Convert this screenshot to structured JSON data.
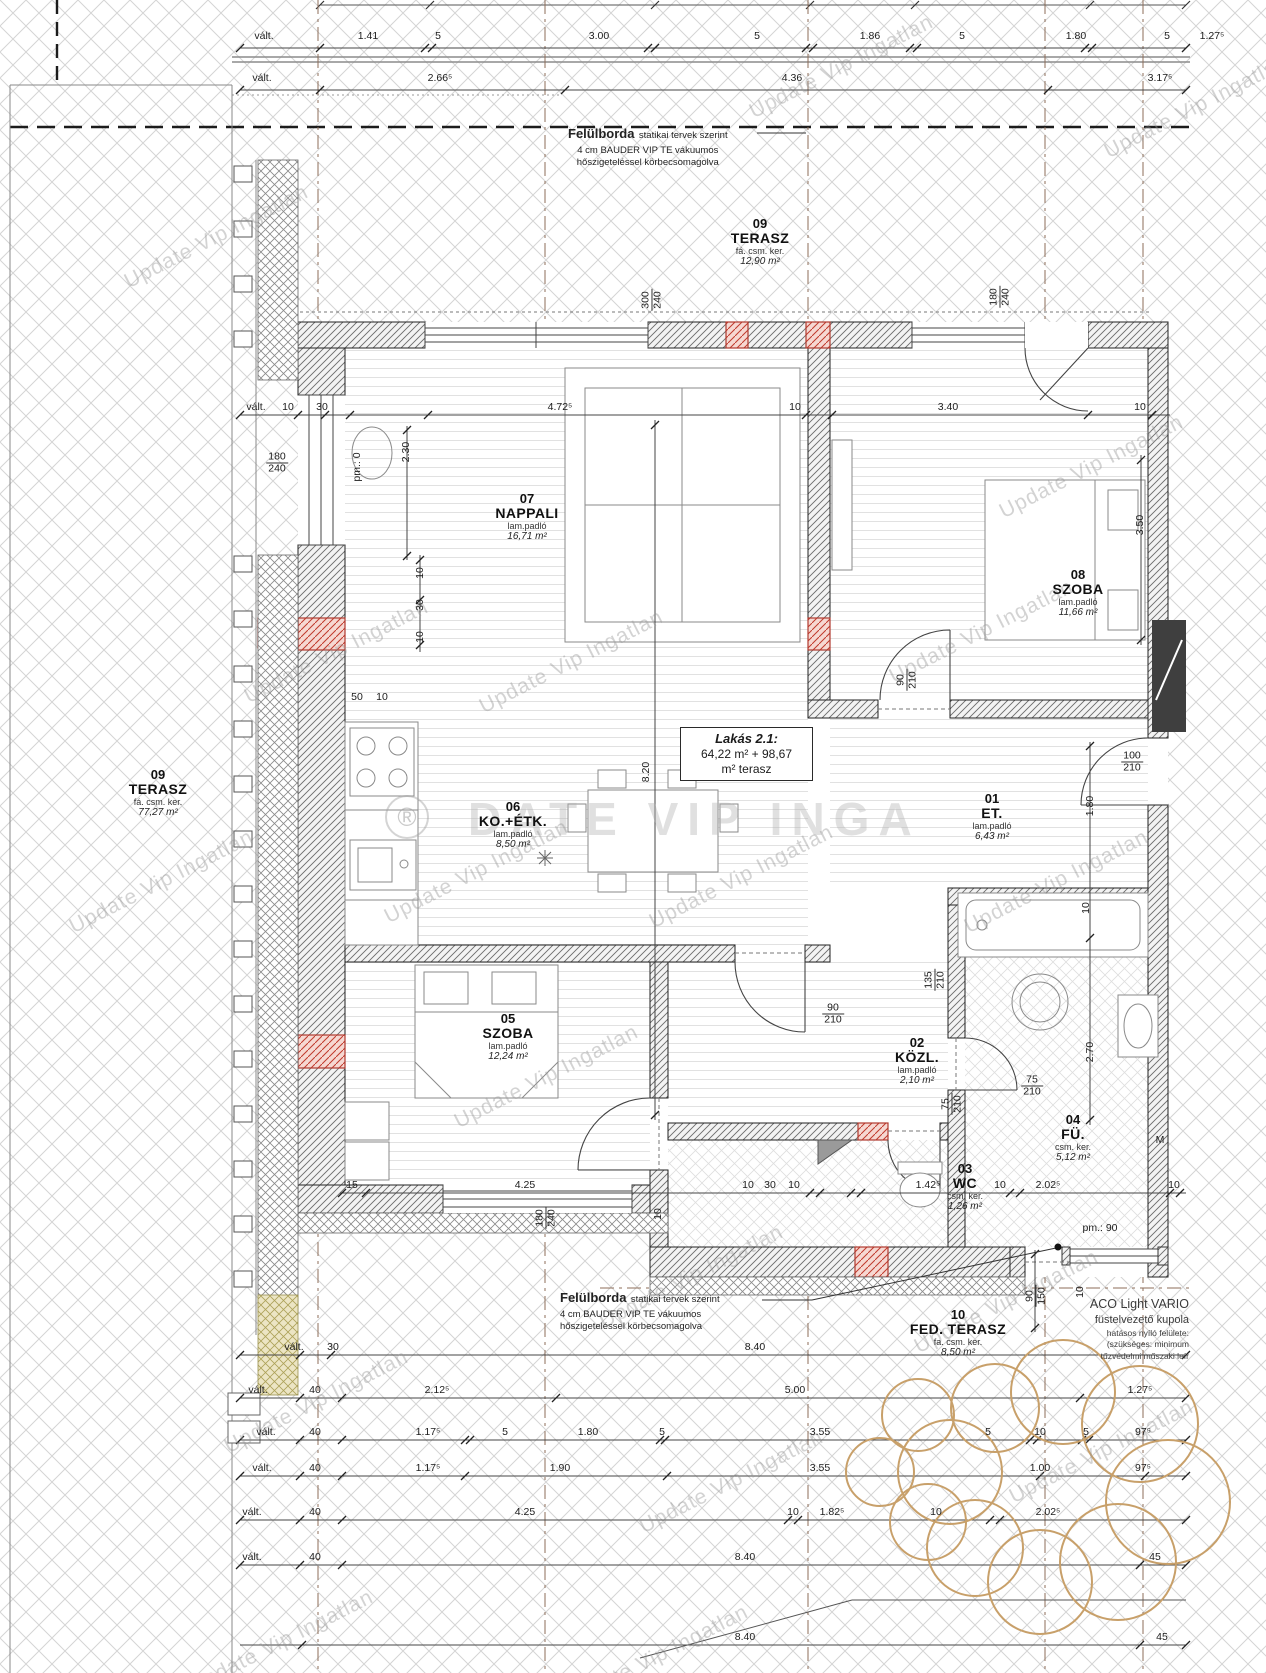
{
  "sheet": {
    "watermark": "Update Vip Ingatlan",
    "watermark_big": "DATE VIP INGA",
    "reg": "®",
    "lakas": {
      "title": "Lakás 2.1:",
      "l1": "64,22 m² + 98,67",
      "l2": "m² terasz"
    },
    "note_top": {
      "strong": "Felülborda",
      "rest": "statikai tervek szerint",
      "l2": "4 cm BAUDER VIP TE vákuumos",
      "l3": "hőszigeteléssel körbecsomagolva"
    },
    "note_bottom": {
      "strong": "Felülborda",
      "rest": "statikai tervek szerint",
      "l2": "4 cm BAUDER VIP TE vákuumos",
      "l3": "hőszigeteléssel körbecsomagolva"
    },
    "aco": {
      "l1": "ACO Light VARIO",
      "l2": "füstelvezető kupola",
      "l3": "hatásos nyíló felülete:",
      "l4": "(szükséges: minimum",
      "l5": "tűzvédelmi műszaki leír"
    },
    "rooms": {
      "terasz_top": {
        "num": "09",
        "name": "TERASZ",
        "floor": "fá. csm. ker.",
        "area": "12,90 m²"
      },
      "terasz_left": {
        "num": "09",
        "name": "TERASZ",
        "floor": "fá. csm. ker.",
        "area": "77,27 m²"
      },
      "nappali": {
        "num": "07",
        "name": "NAPPALI",
        "floor": "lam.padló",
        "area": "16,71 m²"
      },
      "szoba8": {
        "num": "08",
        "name": "SZOBA",
        "floor": "lam.padló",
        "area": "11,66 m²"
      },
      "koetk": {
        "num": "06",
        "name": "KO.+ÉTK.",
        "floor": "lam.padló",
        "area": "8,50 m²"
      },
      "et": {
        "num": "01",
        "name": "ET.",
        "floor": "lam.padló",
        "area": "6,43 m²"
      },
      "szoba5": {
        "num": "05",
        "name": "SZOBA",
        "floor": "lam.padló",
        "area": "12,24 m²"
      },
      "kozl": {
        "num": "02",
        "name": "KÖZL.",
        "floor": "lam.padló",
        "area": "2,10 m²"
      },
      "fu": {
        "num": "04",
        "name": "FÜ.",
        "floor": "csm. ker.",
        "area": "5,12 m²"
      },
      "wc": {
        "num": "03",
        "name": "WC",
        "floor": "csm. ker.",
        "area": "1,26 m²"
      },
      "fedterasz": {
        "num": "10",
        "name": "FED. TERASZ",
        "floor": "fa. csm. ker.",
        "area": "8,50 m²"
      }
    },
    "dims": {
      "top1": [
        "vált.",
        "1.41",
        "5",
        "3.00",
        "5",
        "1.86",
        "5",
        "1.80",
        "5",
        "1.27⁵"
      ],
      "top2": [
        "vált.",
        "2.66⁵",
        "4.36",
        "3.17⁵"
      ],
      "mid": [
        "vált.",
        "10",
        "30",
        "4.72⁵",
        "10",
        "3.40",
        "10"
      ],
      "b1": [
        "vált.",
        "30",
        "8.40"
      ],
      "b2": [
        "vált.",
        "40",
        "2.12⁵",
        "5.00",
        "1.27⁵"
      ],
      "b3": [
        "vált.",
        "40",
        "1.17⁵",
        "5",
        "1.80",
        "5",
        "3.55",
        "5",
        "10",
        "5",
        "97⁵"
      ],
      "b4": [
        "vált.",
        "40",
        "1.17⁵",
        "1.90",
        "3.55",
        "1.00",
        "97⁵"
      ],
      "b5": [
        "vált.",
        "40",
        "4.25",
        "10",
        "1.82⁵",
        "10",
        "2.02⁵"
      ],
      "b6": [
        "vált.",
        "40",
        "8.40",
        "45"
      ],
      "b7": [
        "8.40",
        "45"
      ],
      "wcrow": [
        "15",
        "4.25",
        "10",
        "30",
        "10",
        "1.42⁵",
        "10",
        "2.02⁵",
        "10"
      ],
      "labels": {
        "ten": "10",
        "thirty": "30",
        "d50": "50",
        "m": "M",
        "pm0": "pm.: 0",
        "pm90": "pm.: 90",
        "d2_30": "2.30",
        "d3_50": "3.50",
        "d8_20": "8.20",
        "d1_80": "1.80",
        "d2_70": "2.70",
        "w300": "300",
        "w240": "240",
        "w180": "180",
        "w135": "135",
        "w210": "210",
        "w100": "100",
        "w90": "90",
        "w75": "75",
        "w150": "150"
      }
    }
  }
}
